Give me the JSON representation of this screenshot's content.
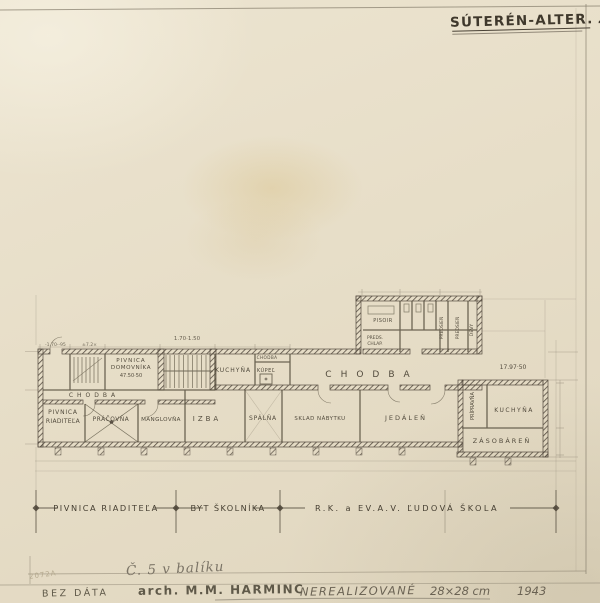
{
  "sheet": {
    "title_main": "SÚTERÉN-ALTER.",
    "title_suffix": "2a.",
    "stamp": "2072A"
  },
  "plan": {
    "rooms": {
      "pivnica_domovnika_1": "PIVNICA",
      "pivnica_domovnika_2": "DOMOVNÍKA",
      "kuchyna_left": "KUCHYŇA",
      "chodba_tiny": "CHODBA",
      "kupel": "KÚPEĽ",
      "chodba_main": "CHODBA",
      "chodba_left": "CHODBA",
      "pisoir": "PISOIR",
      "preds_1": "PREDS.",
      "preds_2": "CHLAP.",
      "predsien_a": "PREDSIEŇ",
      "predsien_b": "PREDSIEŇ",
      "devy": "DEVY",
      "pivnica_riaditela_1": "PIVNICA",
      "pivnica_riaditela_2": "RIADITEĽA",
      "prachovna": "PRÁČOVŇA",
      "manglovna": "MANGLOVŇA",
      "izba": "IZBA",
      "spalna": "SPÁLŇA",
      "sklad_nabytku": "SKLAD NÁBYTKU",
      "jedalen": "JEDÁLEŇ",
      "pripravna": "PRÍPRAVŇA",
      "kuchyna_right": "KUCHYŇA",
      "zasobaren": "ZÁSOBÁREŇ"
    },
    "dimensions": {
      "entry_a": "-1.70·-95",
      "entry_b": "±7.2×",
      "domovnika": "47.50·50",
      "stair": "1.70·1.50",
      "right": "17.97·50"
    }
  },
  "zones": {
    "left": "PIVNICA RIADITEĽA",
    "mid": "BYT ŠKOLNÍKA",
    "right": "R.K. a EV.A.V. ĽUDOVÁ ŠKOLA"
  },
  "annotations": {
    "note": "Č. 5 v balíku",
    "bez_data": "BEZ DÁTA",
    "author": "arch. M.M. HARMINC",
    "status": "NEREALIZOVANÉ",
    "size": "28×28 cm",
    "year": "1943"
  }
}
